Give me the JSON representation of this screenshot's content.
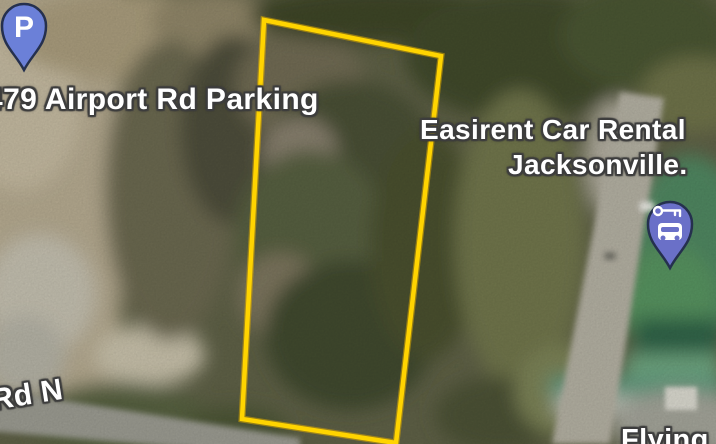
{
  "colors": {
    "boundary": "#FFD400",
    "boundary_underlay": "#D8A800",
    "parking_pin_fill": "#6B80D8",
    "car_rental_pin_fill": "#6A70C8",
    "pin_outline": "#25304E",
    "label_text": "#FFFFFF"
  },
  "map": {
    "boundary_points": "264,20 441,56 396,443 242,419",
    "labels": {
      "parking_poi": "479 Airport Rd Parking",
      "car_rental_line1": "Easirent Car Rental",
      "car_rental_line2": "Jacksonville.",
      "road_name": "Rd N",
      "bottom_poi": "Flying"
    },
    "pins": {
      "parking_glyph": "P"
    }
  }
}
